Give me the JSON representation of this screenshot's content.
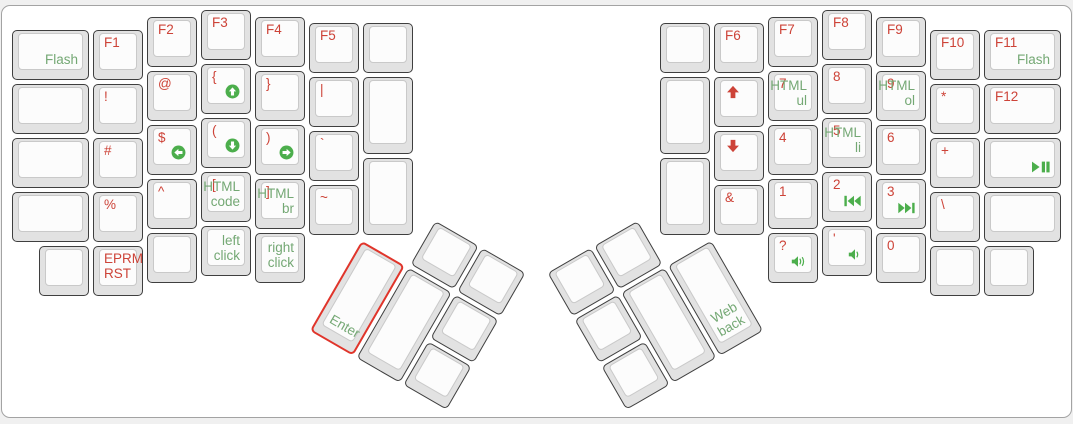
{
  "app": {
    "view_title": "ErgoDox keyboard layout"
  },
  "colors": {
    "legend_red": "#cd4338",
    "legend_green": "#74a874",
    "icon_green": "#4cae4c",
    "selected_outline": "#e0352b",
    "keycap_side": "#e2e2e2",
    "keycap_face": "#fcfcfc",
    "keycap_border": "#3f3f3f",
    "canvas_bg": "#ffffff",
    "page_bg": "#f0f0f0"
  },
  "keyboard": {
    "unit_px": 54,
    "groups": {
      "left-main": {
        "x": 0,
        "y": 0,
        "r": 0
      },
      "left-thumb": {
        "x": 361,
        "y": 237.5,
        "r": 30
      },
      "right-main": {
        "x": 0,
        "y": 0,
        "r": 0
      },
      "right-thumb": {
        "x": 712,
        "y": 237.5,
        "r": -30
      }
    },
    "keys": [
      {
        "n": "key-flash",
        "g": "left-main",
        "x": 10,
        "y": 28,
        "w": 81,
        "green": "Flash"
      },
      {
        "n": "key-blank",
        "g": "left-main",
        "x": 10,
        "y": 82,
        "w": 81
      },
      {
        "n": "key-blank",
        "g": "left-main",
        "x": 10,
        "y": 136,
        "w": 81
      },
      {
        "n": "key-blank",
        "g": "left-main",
        "x": 10,
        "y": 190,
        "w": 81
      },
      {
        "n": "key-f1",
        "g": "left-main",
        "x": 91,
        "y": 28,
        "red": "F1"
      },
      {
        "n": "key-exclamation",
        "g": "left-main",
        "x": 91,
        "y": 82,
        "red": "!"
      },
      {
        "n": "key-hash",
        "g": "left-main",
        "x": 91,
        "y": 136,
        "red": "#"
      },
      {
        "n": "key-percent",
        "g": "left-main",
        "x": 91,
        "y": 190,
        "red": "%"
      },
      {
        "n": "key-eprm-rst",
        "g": "left-main",
        "x": 91,
        "y": 244,
        "red": "EPRM\nRST"
      },
      {
        "n": "key-f2",
        "g": "left-main",
        "x": 145,
        "y": 15,
        "red": "F2"
      },
      {
        "n": "key-at",
        "g": "left-main",
        "x": 145,
        "y": 69,
        "red": "@"
      },
      {
        "n": "key-dollar-scroll-left",
        "g": "left-main",
        "x": 145,
        "y": 123,
        "red": "$",
        "icon": "scroll-left-circle",
        "ip": "br"
      },
      {
        "n": "key-caret",
        "g": "left-main",
        "x": 145,
        "y": 177,
        "red": "^"
      },
      {
        "n": "key-blank",
        "g": "left-main",
        "x": 145,
        "y": 231
      },
      {
        "n": "key-f3",
        "g": "left-main",
        "x": 199,
        "y": 8,
        "red": "F3"
      },
      {
        "n": "key-open-brace-scroll-up",
        "g": "left-main",
        "x": 199,
        "y": 62,
        "red": "{",
        "icon": "scroll-up-circle",
        "ip": "br"
      },
      {
        "n": "key-open-paren-scroll-down",
        "g": "left-main",
        "x": 199,
        "y": 116,
        "red": "(",
        "icon": "scroll-down-circle",
        "ip": "br"
      },
      {
        "n": "key-open-bracket-html-code",
        "g": "left-main",
        "x": 199,
        "y": 170,
        "red": "[",
        "green": "HTML\ncode"
      },
      {
        "n": "key-left-click",
        "g": "left-main",
        "x": 199,
        "y": 224,
        "green": "left\nclick"
      },
      {
        "n": "key-f4",
        "g": "left-main",
        "x": 253,
        "y": 15,
        "red": "F4"
      },
      {
        "n": "key-close-brace",
        "g": "left-main",
        "x": 253,
        "y": 69,
        "red": "}"
      },
      {
        "n": "key-close-paren-scroll-right",
        "g": "left-main",
        "x": 253,
        "y": 123,
        "red": ")",
        "icon": "scroll-right-circle",
        "ip": "br"
      },
      {
        "n": "key-close-bracket-html-br",
        "g": "left-main",
        "x": 253,
        "y": 177,
        "red": "]",
        "green": "HTML\nbr"
      },
      {
        "n": "key-right-click",
        "g": "left-main",
        "x": 253,
        "y": 231,
        "green": "right\nclick"
      },
      {
        "n": "key-f5",
        "g": "left-main",
        "x": 307,
        "y": 21,
        "red": "F5"
      },
      {
        "n": "key-pipe",
        "g": "left-main",
        "x": 307,
        "y": 75,
        "red": "|"
      },
      {
        "n": "key-backtick",
        "g": "left-main",
        "x": 307,
        "y": 129,
        "red": "`"
      },
      {
        "n": "key-tilde",
        "g": "left-main",
        "x": 307,
        "y": 183,
        "red": "~"
      },
      {
        "n": "key-blank",
        "g": "left-main",
        "x": 361,
        "y": 21
      },
      {
        "n": "key-blank",
        "g": "left-main",
        "x": 361,
        "y": 75,
        "h": 81
      },
      {
        "n": "key-blank",
        "g": "left-main",
        "x": 361,
        "y": 156,
        "h": 81
      },
      {
        "n": "key-blank",
        "g": "left-main",
        "x": 37,
        "y": 244
      },
      {
        "n": "key-blank",
        "g": "left-thumb",
        "x": 54,
        "y": -54
      },
      {
        "n": "key-blank",
        "g": "left-thumb",
        "x": 108,
        "y": -54
      },
      {
        "n": "key-enter",
        "g": "left-thumb",
        "x": 0,
        "y": 0,
        "h": 108,
        "green": "Enter",
        "ga": "bl",
        "sel": true
      },
      {
        "n": "key-blank",
        "g": "left-thumb",
        "x": 54,
        "y": 0,
        "h": 108
      },
      {
        "n": "key-blank",
        "g": "left-thumb",
        "x": 108,
        "y": 0
      },
      {
        "n": "key-blank",
        "g": "left-thumb",
        "x": 108,
        "y": 54
      },
      {
        "n": "key-blank",
        "g": "right-main",
        "x": 658,
        "y": 21
      },
      {
        "n": "key-blank",
        "g": "right-main",
        "x": 658,
        "y": 75,
        "h": 81
      },
      {
        "n": "key-blank",
        "g": "right-main",
        "x": 658,
        "y": 156,
        "h": 81
      },
      {
        "n": "key-f6",
        "g": "right-main",
        "x": 712,
        "y": 21,
        "red": "F6"
      },
      {
        "n": "key-cursor-up",
        "g": "right-main",
        "x": 712,
        "y": 75,
        "icon": "red-arrow-up",
        "ip": "tl"
      },
      {
        "n": "key-cursor-down",
        "g": "right-main",
        "x": 712,
        "y": 129,
        "icon": "red-arrow-down",
        "ip": "tl"
      },
      {
        "n": "key-ampersand",
        "g": "right-main",
        "x": 712,
        "y": 183,
        "red": "&"
      },
      {
        "n": "key-f7",
        "g": "right-main",
        "x": 766,
        "y": 15,
        "red": "F7"
      },
      {
        "n": "key-7-html-ul",
        "g": "right-main",
        "x": 766,
        "y": 69,
        "red": "7",
        "green": "HTML\nul"
      },
      {
        "n": "key-4",
        "g": "right-main",
        "x": 766,
        "y": 123,
        "red": "4"
      },
      {
        "n": "key-1",
        "g": "right-main",
        "x": 766,
        "y": 177,
        "red": "1"
      },
      {
        "n": "key-question-volume-up",
        "g": "right-main",
        "x": 766,
        "y": 231,
        "red": "?",
        "icon": "volume-up",
        "ip": "br"
      },
      {
        "n": "key-f8",
        "g": "right-main",
        "x": 820,
        "y": 8,
        "red": "F8"
      },
      {
        "n": "key-8",
        "g": "right-main",
        "x": 820,
        "y": 62,
        "red": "8"
      },
      {
        "n": "key-5-html-li",
        "g": "right-main",
        "x": 820,
        "y": 116,
        "red": "5",
        "green": "HTML\nli"
      },
      {
        "n": "key-2-prev-track",
        "g": "right-main",
        "x": 820,
        "y": 170,
        "red": "2",
        "icon": "prev-track",
        "ip": "br"
      },
      {
        "n": "key-apostrophe-volume-down",
        "g": "right-main",
        "x": 820,
        "y": 224,
        "red": "'",
        "icon": "volume-down",
        "ip": "br"
      },
      {
        "n": "key-f9",
        "g": "right-main",
        "x": 874,
        "y": 15,
        "red": "F9"
      },
      {
        "n": "key-9-html-ol",
        "g": "right-main",
        "x": 874,
        "y": 69,
        "red": "9",
        "green": "HTML\nol"
      },
      {
        "n": "key-6",
        "g": "right-main",
        "x": 874,
        "y": 123,
        "red": "6"
      },
      {
        "n": "key-3-next-track",
        "g": "right-main",
        "x": 874,
        "y": 177,
        "red": "3",
        "icon": "next-track",
        "ip": "br"
      },
      {
        "n": "key-0",
        "g": "right-main",
        "x": 874,
        "y": 231,
        "red": "0"
      },
      {
        "n": "key-f10",
        "g": "right-main",
        "x": 928,
        "y": 28,
        "red": "F10"
      },
      {
        "n": "key-asterisk",
        "g": "right-main",
        "x": 928,
        "y": 82,
        "red": "*"
      },
      {
        "n": "key-plus",
        "g": "right-main",
        "x": 928,
        "y": 136,
        "red": "+"
      },
      {
        "n": "key-backslash",
        "g": "right-main",
        "x": 928,
        "y": 190,
        "red": "\\"
      },
      {
        "n": "key-blank",
        "g": "right-main",
        "x": 928,
        "y": 244
      },
      {
        "n": "key-f11-flash",
        "g": "right-main",
        "x": 982,
        "y": 28,
        "w": 81,
        "red": "F11",
        "green": "Flash"
      },
      {
        "n": "key-f12",
        "g": "right-main",
        "x": 982,
        "y": 82,
        "w": 81,
        "red": "F12"
      },
      {
        "n": "key-play-pause",
        "g": "right-main",
        "x": 982,
        "y": 136,
        "w": 81,
        "icon": "play-pause",
        "ip": "br"
      },
      {
        "n": "key-blank",
        "g": "right-main",
        "x": 982,
        "y": 190,
        "w": 81
      },
      {
        "n": "key-blank",
        "g": "right-main",
        "x": 982,
        "y": 244
      },
      {
        "n": "key-blank",
        "g": "right-thumb",
        "x": -162,
        "y": -54
      },
      {
        "n": "key-blank",
        "g": "right-thumb",
        "x": -108,
        "y": -54
      },
      {
        "n": "key-blank",
        "g": "right-thumb",
        "x": -162,
        "y": 0
      },
      {
        "n": "key-blank",
        "g": "right-thumb",
        "x": -162,
        "y": 54
      },
      {
        "n": "key-blank",
        "g": "right-thumb",
        "x": -108,
        "y": 0,
        "h": 108
      },
      {
        "n": "key-web-back",
        "g": "right-thumb",
        "x": -54,
        "y": 0,
        "h": 108,
        "green": "Web\nback"
      }
    ]
  }
}
